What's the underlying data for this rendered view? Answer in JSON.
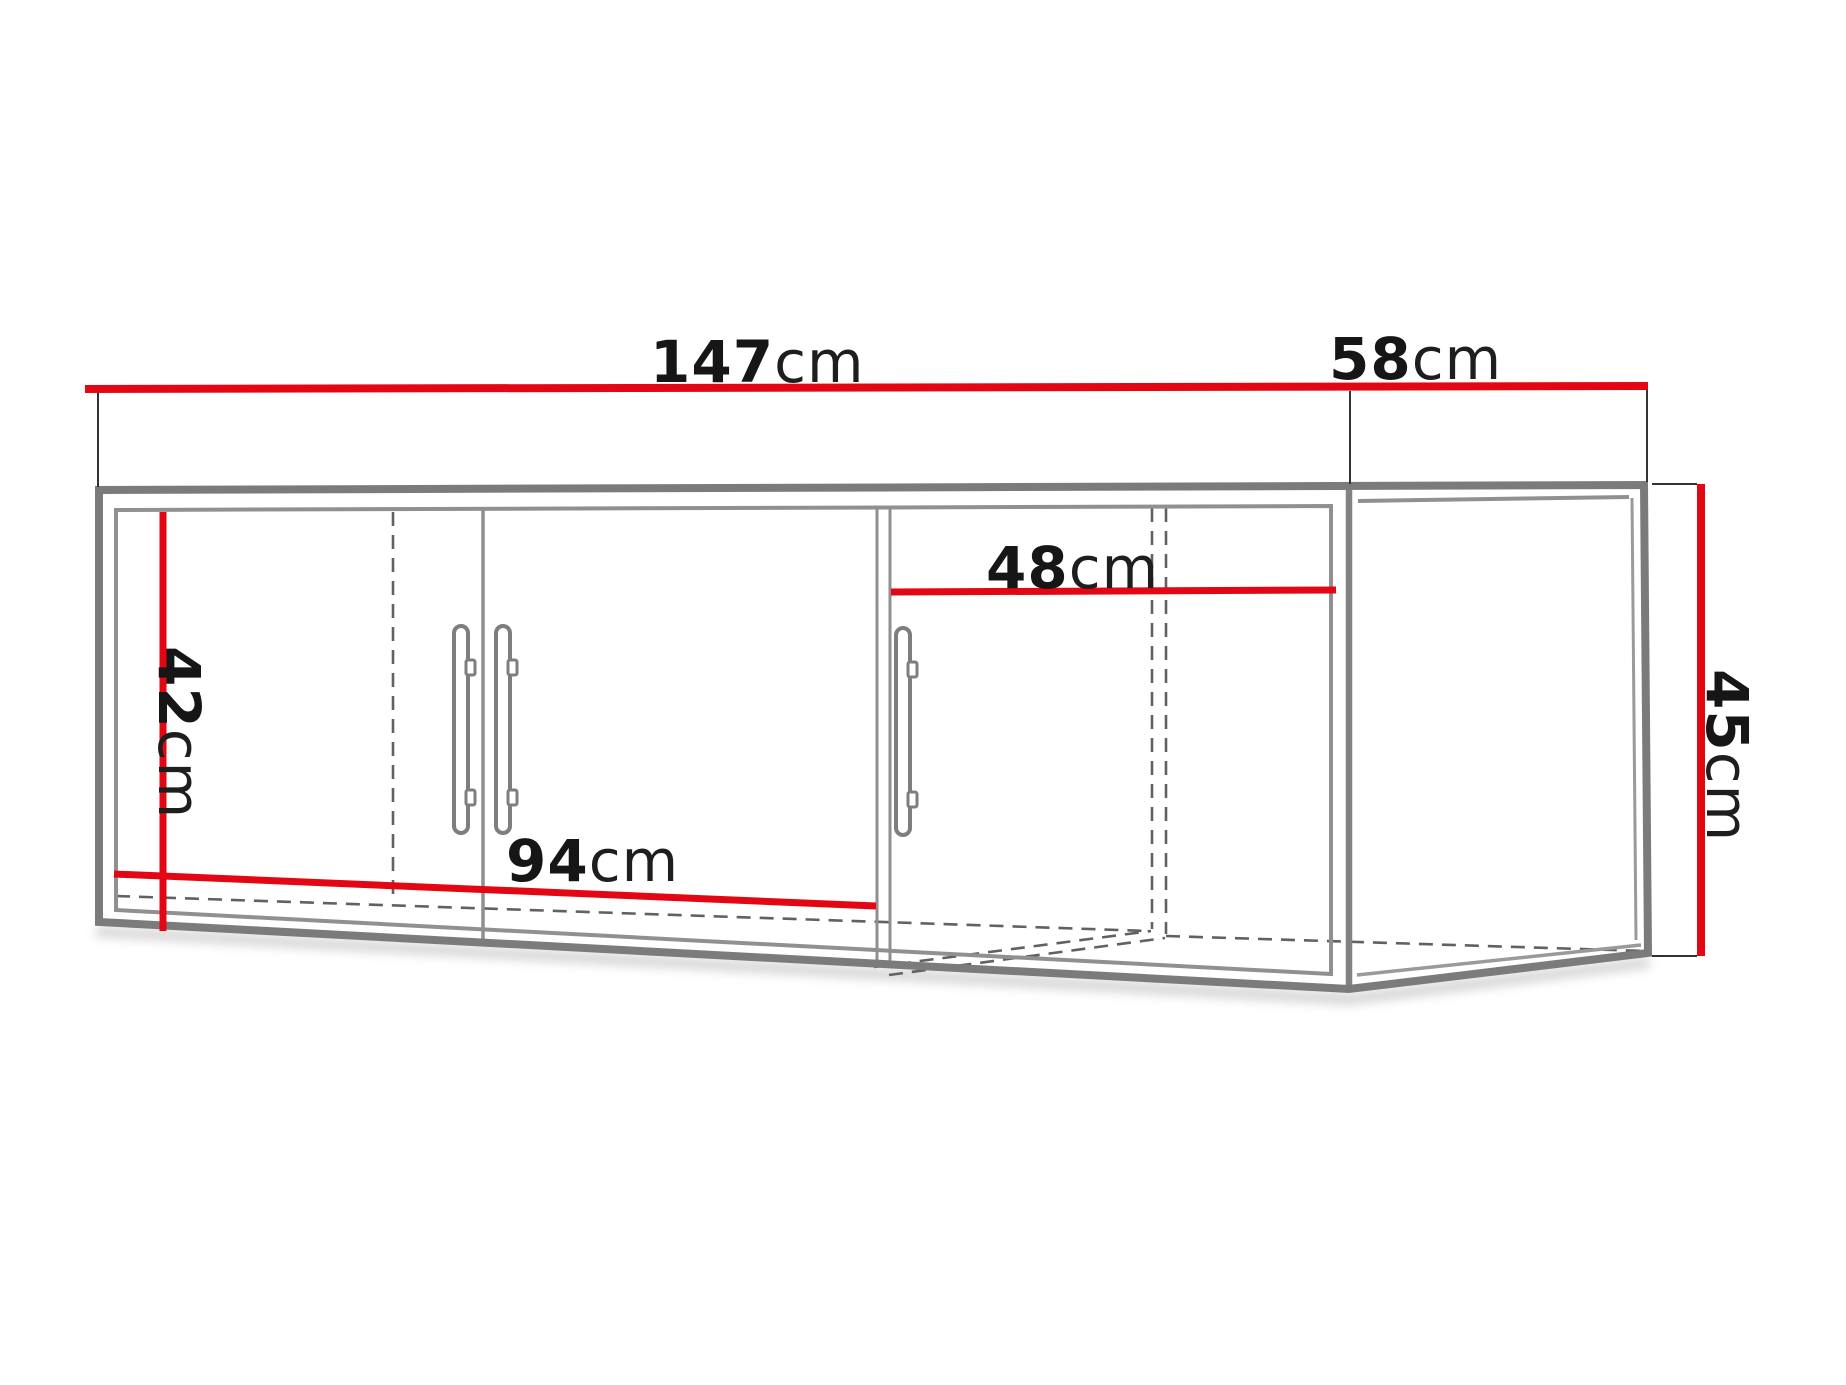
{
  "page": {
    "background": "#ffffff",
    "description": "Technical dimension diagram of a wall-mounted corner cabinet with three doors and an open side niche"
  },
  "colors": {
    "dimension_line": "#e30613",
    "cabinet_outline": "#7b7b7b",
    "inner_line": "#909090",
    "hidden_dashed_line": "#616161",
    "extension_line": "#333333",
    "label_text": "#161616",
    "shadow": "#b5b5b5"
  },
  "dims": {
    "width": {
      "value": "147",
      "unit": "cm"
    },
    "depth": {
      "value": "58",
      "unit": "cm"
    },
    "height": {
      "value": "45",
      "unit": "cm"
    },
    "interior_height": {
      "value": "42",
      "unit": "cm"
    },
    "left_section_width": {
      "value": "94",
      "unit": "cm"
    },
    "right_section_width": {
      "value": "48",
      "unit": "cm"
    }
  }
}
